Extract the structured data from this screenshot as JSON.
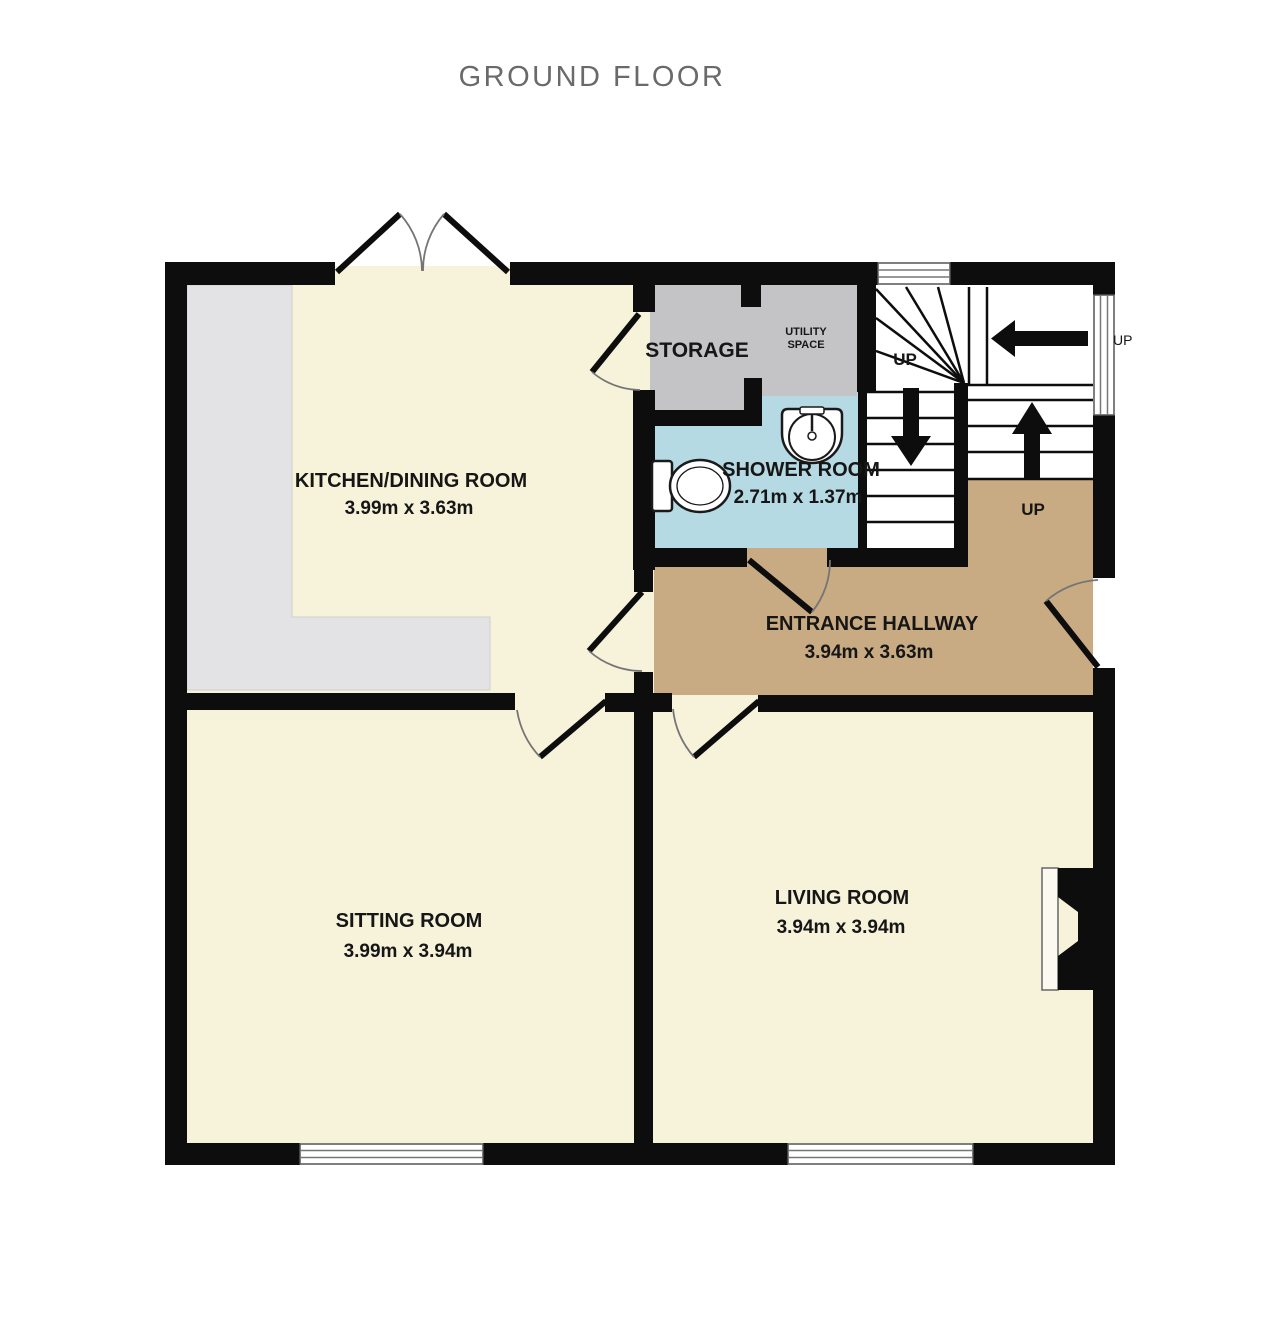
{
  "title": "GROUND FLOOR",
  "rooms": {
    "kitchen": {
      "label": "KITCHEN/DINING ROOM",
      "dims": "3.99m x 3.63m"
    },
    "sitting": {
      "label": "SITTING ROOM",
      "dims": "3.99m x 3.94m"
    },
    "living": {
      "label": "LIVING ROOM",
      "dims": "3.94m x 3.94m"
    },
    "hallway": {
      "label": "ENTRANCE HALLWAY",
      "dims": "3.94m x 3.63m"
    },
    "shower": {
      "label": "SHOWER ROOM",
      "dims": "2.71m x 1.37m"
    },
    "storage": {
      "label": "STORAGE"
    },
    "utility": {
      "line1": "UTILITY",
      "line2": "SPACE"
    }
  },
  "stairs": {
    "up_winder": "UP",
    "up_hall": "UP",
    "up_outside": "UP"
  },
  "colors": {
    "wall": "#0d0d0d",
    "floor-cream": "#f7f3da",
    "floor-tan": "#c9ab83",
    "floor-blue": "#b6dae3",
    "storage-gray": "#c4c4c6",
    "counter-gray": "#e3e3e5",
    "title-gray": "#6a6a6a",
    "label-dark": "#161616"
  }
}
